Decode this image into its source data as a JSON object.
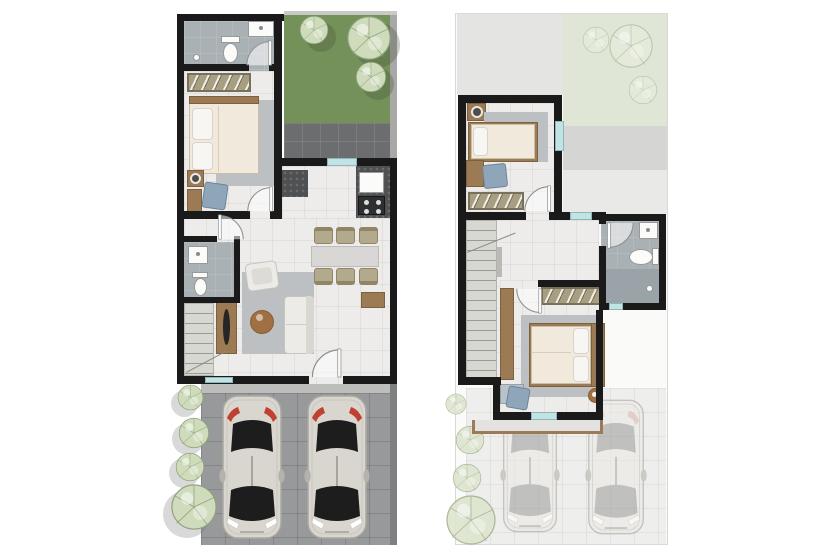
{
  "meta": {
    "type": "architectural-floor-plan",
    "views": [
      "ground-floor",
      "upper-floor"
    ],
    "text_labels": []
  },
  "palette": {
    "wall": "#1a1a1a",
    "floor": "#edecea",
    "bath_floor": "#a9b1b5",
    "shower_floor": "#9aa3a8",
    "grass": "#75915a",
    "grass_faded": "#e0e6d6",
    "patio": "#6b6d6e",
    "carport": "#98999a",
    "carport_faded": "#eeeeec",
    "roof": "#e4e4e3",
    "roof_band": "#d5d5d4",
    "roof_band_light": "#e9e9e8",
    "tree_fill": "#cfdcbc",
    "tree_line": "#8fa27e",
    "wood": "#9c7a53",
    "wood_dark": "#7c6140",
    "wardrobe": "#a89f82",
    "bed": "#f0e9dc",
    "pillow": "#f8f6f2",
    "rug": "#bdc0c2",
    "sofa": "#edebe7",
    "coffee_table": "#a06f42",
    "chair_tan": "#b3a98c",
    "dining_table": "#d8d7d5",
    "counter": "#4e5052",
    "window_teal": "#c2e3e3",
    "car_body": "#d9d6cf",
    "car_glass": "#1d1d1d",
    "car_red": "#c2402f",
    "chair_blue": "#8fa6ba",
    "stairs": "#d8d8d3",
    "step_line": "#9b9b94",
    "lot_line": "#d9d9d7"
  },
  "ground_floor": {
    "rooms": [
      {
        "name": "bathroom",
        "fixtures": [
          "toilet",
          "sink",
          "floor-drain",
          "door"
        ]
      },
      {
        "name": "bedroom",
        "fixtures": [
          "wardrobe",
          "double-bed",
          "rug",
          "nightstand",
          "lamp",
          "desk",
          "chair",
          "door"
        ]
      },
      {
        "name": "garden",
        "tree_count": 3
      },
      {
        "name": "patio",
        "fixtures": []
      },
      {
        "name": "kitchen",
        "fixtures": [
          "counter",
          "kitchen-sink",
          "stove",
          "window"
        ]
      },
      {
        "name": "dining",
        "fixtures": [
          "dining-table",
          "sideboard"
        ],
        "chair_count": 6
      },
      {
        "name": "living",
        "fixtures": [
          "sofa",
          "armchair",
          "coffee-table",
          "tv-console",
          "rug"
        ]
      },
      {
        "name": "powder-room",
        "fixtures": [
          "toilet",
          "sink",
          "door"
        ]
      },
      {
        "name": "staircase",
        "fixtures": [
          "steps"
        ]
      },
      {
        "name": "entrance",
        "fixtures": [
          "front-door",
          "mat"
        ]
      },
      {
        "name": "carport",
        "car_count": 2
      },
      {
        "name": "landscaping",
        "bush_count": 4
      }
    ]
  },
  "upper_floor": {
    "rooms": [
      {
        "name": "bedroom-2",
        "fixtures": [
          "single-bed",
          "rug",
          "nightstand",
          "lamp",
          "desk",
          "chair",
          "wardrobe",
          "window",
          "door"
        ]
      },
      {
        "name": "hallway",
        "fixtures": [
          "window"
        ]
      },
      {
        "name": "staircase",
        "fixtures": [
          "steps",
          "handrail"
        ]
      },
      {
        "name": "bathroom",
        "fixtures": [
          "sink",
          "toilet",
          "shower-drain",
          "window",
          "door"
        ]
      },
      {
        "name": "master-bedroom",
        "fixtures": [
          "double-bed",
          "rug",
          "wardrobe",
          "dresser",
          "desk",
          "chair",
          "side-table",
          "window",
          "door"
        ]
      },
      {
        "name": "balcony",
        "fixtures": []
      },
      {
        "name": "ground-floor-ghost",
        "visible_below": [
          "roof",
          "garden",
          "carport"
        ],
        "car_count": 2,
        "bush_count": 4,
        "tree_count": 3
      }
    ]
  }
}
